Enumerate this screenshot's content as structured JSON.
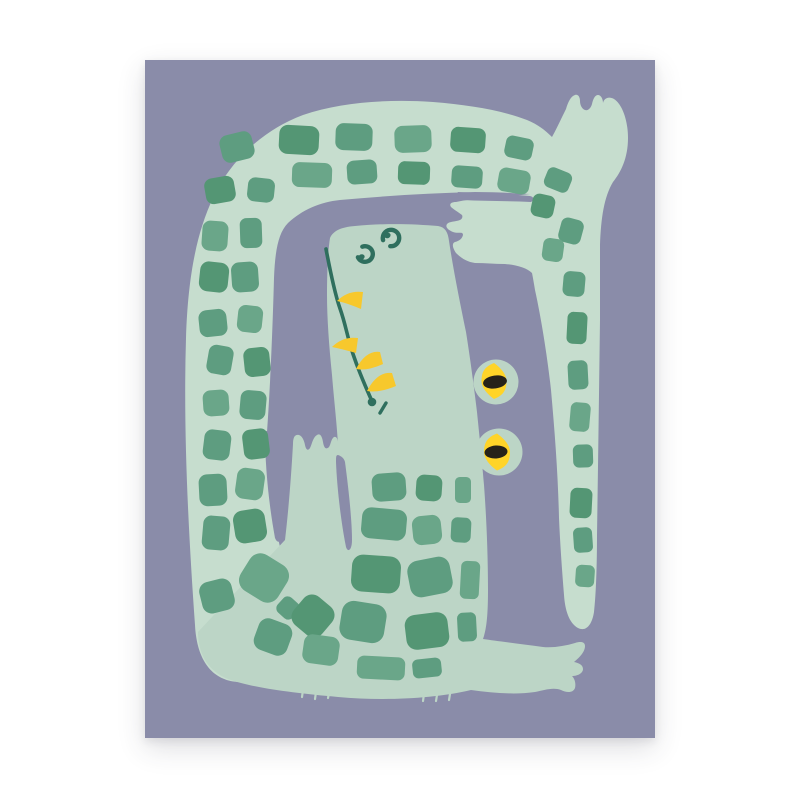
{
  "page": {
    "background_color": "#ffffff"
  },
  "poster": {
    "title": "Crocodile art print",
    "description": "Flat illustration of a mint green crocodile with dark green square scales, curled so its checkered tail wraps around the left, top and right of its snout; two bulging yellow eyes with black pupils, a long mouth line with yellow teeth, and splayed hands and feet, on a dusty purple background.",
    "frame": {
      "left": 145,
      "top": 60,
      "width": 510,
      "height": 678
    },
    "palette": {
      "background_purple": "#8a8ca9",
      "band_green": "#c6ddce",
      "body_green": "#bcd5c6",
      "square_greens": [
        "#5e9d80",
        "#549674",
        "#6aa689",
        "#5a9a7c"
      ],
      "detail_teal": "#2f6f5e",
      "tooth_yellow": "#f7c82c",
      "eye_yellow": "#ffd428",
      "pupil_black": "#262219"
    },
    "scales": [
      [
        92,
        87,
        33,
        28,
        -14,
        0
      ],
      [
        154,
        80,
        40,
        29,
        3,
        1
      ],
      [
        209,
        77,
        37,
        27,
        2,
        0
      ],
      [
        268,
        79,
        37,
        27,
        -2,
        2
      ],
      [
        323,
        80,
        35,
        25,
        4,
        1
      ],
      [
        374,
        88,
        28,
        22,
        12,
        0
      ],
      [
        167,
        115,
        40,
        25,
        2,
        2
      ],
      [
        217,
        112,
        30,
        24,
        -4,
        0
      ],
      [
        269,
        113,
        32,
        23,
        2,
        1
      ],
      [
        322,
        117,
        31,
        22,
        4,
        0
      ],
      [
        369,
        121,
        32,
        24,
        10,
        2
      ],
      [
        75,
        130,
        30,
        26,
        -10,
        1
      ],
      [
        116,
        130,
        27,
        24,
        6,
        0
      ],
      [
        70,
        176,
        26,
        30,
        4,
        2
      ],
      [
        106,
        173,
        22,
        30,
        -2,
        0
      ],
      [
        69,
        217,
        29,
        30,
        6,
        1
      ],
      [
        100,
        217,
        27,
        30,
        -4,
        0
      ],
      [
        68,
        263,
        28,
        27,
        -6,
        0
      ],
      [
        105,
        259,
        25,
        27,
        6,
        2
      ],
      [
        75,
        300,
        25,
        29,
        10,
        0
      ],
      [
        112,
        302,
        26,
        29,
        -6,
        1
      ],
      [
        71,
        343,
        26,
        26,
        -4,
        2
      ],
      [
        108,
        345,
        26,
        29,
        5,
        0
      ],
      [
        72,
        385,
        27,
        30,
        7,
        0
      ],
      [
        111,
        384,
        26,
        30,
        -7,
        1
      ],
      [
        68,
        430,
        28,
        32,
        -3,
        0
      ],
      [
        105,
        424,
        28,
        31,
        8,
        2
      ],
      [
        71,
        473,
        27,
        34,
        5,
        0
      ],
      [
        105,
        466,
        32,
        33,
        -9,
        1
      ],
      [
        72,
        536,
        33,
        32,
        -14,
        0
      ],
      [
        119,
        518,
        44,
        42,
        32,
        2
      ],
      [
        143,
        548,
        20,
        20,
        42,
        0
      ],
      [
        168,
        556,
        37,
        37,
        40,
        1
      ],
      [
        128,
        577,
        35,
        33,
        20,
        0
      ],
      [
        176,
        590,
        36,
        29,
        8,
        2
      ],
      [
        244,
        427,
        34,
        28,
        -4,
        0
      ],
      [
        284,
        428,
        26,
        26,
        4,
        1
      ],
      [
        318,
        430,
        16,
        26,
        0,
        2
      ],
      [
        239,
        464,
        45,
        31,
        5,
        0
      ],
      [
        282,
        470,
        29,
        29,
        -6,
        2
      ],
      [
        316,
        470,
        20,
        25,
        3,
        0
      ],
      [
        231,
        514,
        49,
        37,
        4,
        1
      ],
      [
        285,
        517,
        43,
        37,
        -11,
        0
      ],
      [
        325,
        520,
        19,
        38,
        3,
        2
      ],
      [
        218,
        562,
        45,
        39,
        9,
        0
      ],
      [
        282,
        571,
        43,
        35,
        -7,
        1
      ],
      [
        322,
        567,
        19,
        29,
        -3,
        0
      ],
      [
        236,
        608,
        48,
        23,
        3,
        2
      ],
      [
        282,
        608,
        29,
        19,
        -6,
        0
      ],
      [
        413,
        120,
        26,
        21,
        22,
        0
      ],
      [
        398,
        146,
        23,
        23,
        12,
        1
      ],
      [
        426,
        171,
        23,
        25,
        15,
        0
      ],
      [
        408,
        190,
        21,
        23,
        8,
        2
      ],
      [
        429,
        224,
        22,
        25,
        5,
        0
      ],
      [
        432,
        268,
        20,
        32,
        3,
        1
      ],
      [
        433,
        315,
        20,
        29,
        -3,
        0
      ],
      [
        435,
        357,
        20,
        29,
        5,
        2
      ],
      [
        438,
        396,
        20,
        23,
        -2,
        0
      ],
      [
        436,
        443,
        22,
        30,
        3,
        1
      ],
      [
        438,
        480,
        19,
        25,
        -4,
        0
      ],
      [
        440,
        516,
        19,
        22,
        4,
        2
      ]
    ],
    "teeth": [
      [
        218,
        232,
        216,
        249,
        192,
        241
      ],
      [
        213,
        278,
        211,
        293,
        187,
        287
      ],
      [
        235,
        292,
        238,
        304,
        211,
        309
      ],
      [
        247,
        313,
        251,
        326,
        222,
        331
      ]
    ],
    "eyes": [
      {
        "bump": [
          351,
          322,
          22.5
        ],
        "iris": [
          349,
          321,
          12.5,
          18
        ],
        "pupil": [
          350,
          322,
          12,
          6.5,
          -8
        ]
      },
      {
        "bump": [
          354,
          392,
          23.5
        ],
        "iris": [
          352,
          392,
          13,
          18.5
        ],
        "pupil": [
          351,
          392,
          11.5,
          6.5,
          -4
        ]
      }
    ],
    "nostrils": [
      {
        "arc": [
          220,
          194,
          7.8,
          -20,
          245
        ],
        "dot": [
          216.5,
          197,
          3.2,
          2.7,
          -25
        ]
      },
      {
        "arc": [
          246,
          178,
          8.2,
          255,
          185
        ],
        "dot": [
          242.5,
          175.5,
          3.2,
          2.7,
          -25
        ]
      }
    ],
    "mouth": {
      "points": [
        [
          181,
          189
        ],
        [
          185,
          210
        ],
        [
          192,
          240
        ],
        [
          198,
          257
        ],
        [
          205,
          285
        ],
        [
          211,
          303
        ],
        [
          219,
          323
        ],
        [
          226,
          339
        ]
      ],
      "end_dot": [
        227,
        342,
        4.3
      ],
      "dash": [
        241,
        343,
        235,
        353
      ]
    },
    "fringe": [
      [
        158,
        630,
        157,
        637
      ],
      [
        171,
        632,
        170,
        639
      ],
      [
        184,
        633,
        183,
        638
      ],
      [
        279,
        634,
        278,
        641
      ],
      [
        292,
        635,
        291,
        641
      ],
      [
        305,
        634,
        304,
        640
      ]
    ]
  }
}
